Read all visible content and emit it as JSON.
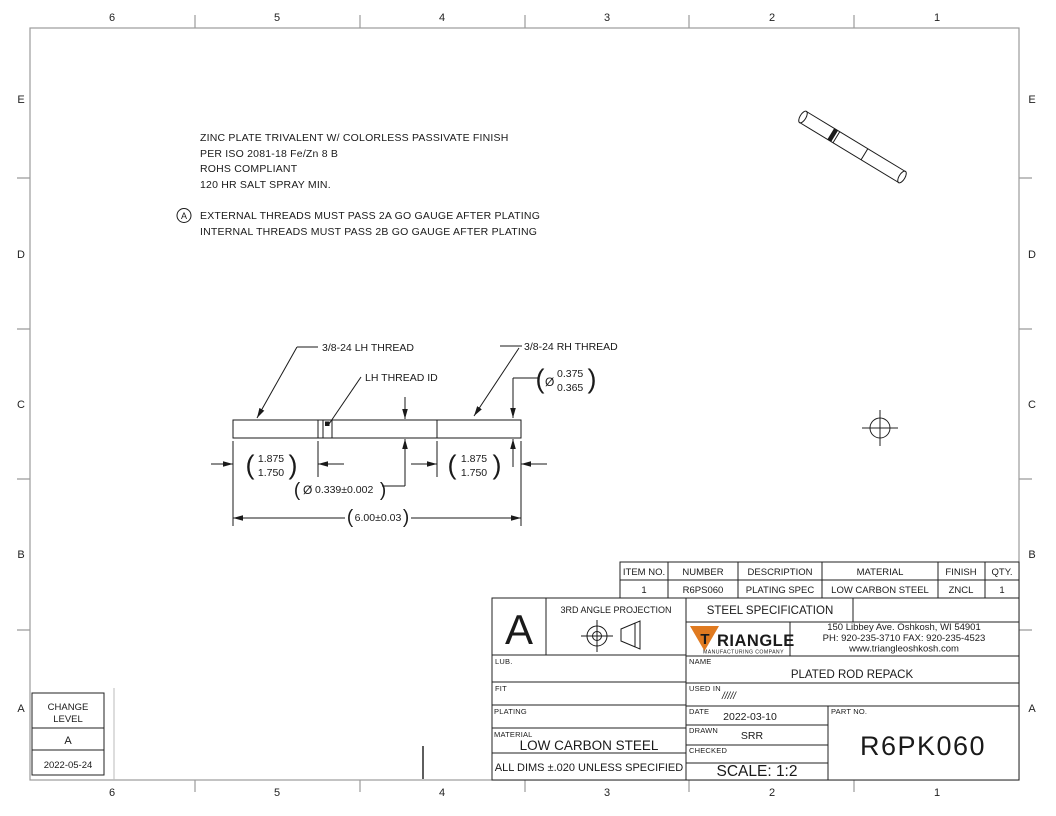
{
  "zones": {
    "columns": [
      "6",
      "5",
      "4",
      "3",
      "2",
      "1"
    ],
    "rows": [
      "E",
      "D",
      "C",
      "B",
      "A"
    ]
  },
  "notes": {
    "line1": "ZINC PLATE TRIVALENT W/ COLORLESS PASSIVATE FINISH",
    "line2": "PER ISO 2081-18 Fe/Zn 8 B",
    "line3": "ROHS COMPLIANT",
    "line4": "120  HR SALT SPRAY MIN.",
    "flag_letter": "A",
    "flag_line1": "EXTERNAL THREADS MUST PASS 2A GO GAUGE AFTER PLATING",
    "flag_line2": "INTERNAL THREADS MUST PASS 2B GO GAUGE AFTER PLATING"
  },
  "callouts": {
    "lh_thread": "3/8-24 LH THREAD",
    "lh_thread_id": "LH THREAD ID",
    "rh_thread": "3/8-24 RH THREAD"
  },
  "glyphs": {
    "paren_open": "(",
    "paren_close": ")",
    "diameter": "Ø"
  },
  "dims": {
    "dia_right_upper": "0.375",
    "dia_right_lower": "0.365",
    "len_left_upper": "1.875",
    "len_left_lower": "1.750",
    "len_right_upper": "1.875",
    "len_right_lower": "1.750",
    "dia_mid": "0.339±0.002",
    "overall": "6.00±0.03"
  },
  "parts_table": {
    "headers": [
      "ITEM NO.",
      "NUMBER",
      "DESCRIPTION",
      "MATERIAL",
      "FINISH",
      "QTY."
    ],
    "row": [
      "1",
      "R6PS060",
      "PLATING SPEC",
      "LOW CARBON STEEL",
      "ZNCL",
      "1"
    ]
  },
  "title_block": {
    "change_letter": "A",
    "projection_label": "3RD ANGLE PROJECTION",
    "spec_header": "STEEL SPECIFICATION",
    "logo_initial": "T",
    "logo_rest": "RIANGLE",
    "logo_tagline": "MANUFACTURING COMPANY",
    "address1": "150 Libbey Ave. Oshkosh, WI  54901",
    "address2": "PH:  920-235-3710 FAX: 920-235-4523",
    "address3": "www.triangleoshkosh.com",
    "lub_label": "LUB.",
    "fit_label": "FIT",
    "plating_label": "PLATING",
    "material_label": "MATERIAL",
    "material_value": "LOW CARBON STEEL",
    "tolerance_note": "ALL DIMS ±.020 UNLESS SPECIFIED",
    "name_label": "NAME",
    "name_value": "PLATED ROD REPACK",
    "used_in_label": "USED IN",
    "used_in_value": "/////",
    "date_label": "DATE",
    "date_value": "2022-03-10",
    "drawn_label": "DRAWN",
    "drawn_value": "SRR",
    "checked_label": "CHECKED",
    "checked_value": "",
    "scale_text": "SCALE: 1:2",
    "part_no_label": "PART NO.",
    "part_no_value": "R6PK060"
  },
  "change_block": {
    "label_line1": "CHANGE",
    "label_line2": "LEVEL",
    "level": "A",
    "date": "2022-05-24"
  },
  "colors": {
    "logo_orange": "#E07A20",
    "logo_navy": "#1B4B8F"
  }
}
